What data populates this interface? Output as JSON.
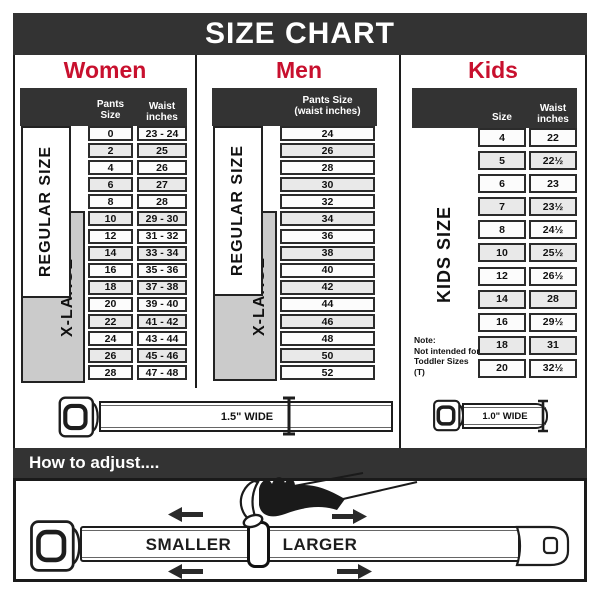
{
  "title_bar": {
    "title": "SIZE CHART"
  },
  "colors": {
    "accent_red": "#c8102e",
    "bar_dark": "#333333",
    "cell_border": "#2b2b2b",
    "row_alt": "#e9e9e9",
    "xlarge_gray": "#cbcbcb"
  },
  "sections": {
    "women": {
      "title": "Women",
      "side_labels": {
        "regular": "REGULAR SIZE",
        "xlarge": "X-LARGE"
      },
      "headers": {
        "col1": "Pants Size",
        "col2_line1": "Waist",
        "col2_line2": "inches"
      },
      "rows": [
        [
          "0",
          "23 - 24"
        ],
        [
          "2",
          "25"
        ],
        [
          "4",
          "26"
        ],
        [
          "6",
          "27"
        ],
        [
          "8",
          "28"
        ],
        [
          "10",
          "29 - 30"
        ],
        [
          "12",
          "31 - 32"
        ],
        [
          "14",
          "33 - 34"
        ],
        [
          "16",
          "35 - 36"
        ],
        [
          "18",
          "37 - 38"
        ],
        [
          "20",
          "39 - 40"
        ],
        [
          "22",
          "41 - 42"
        ],
        [
          "24",
          "43 - 44"
        ],
        [
          "26",
          "45 - 46"
        ],
        [
          "28",
          "47 - 48"
        ]
      ],
      "belt": {
        "width_label": "1.5\" WIDE"
      }
    },
    "men": {
      "title": "Men",
      "side_labels": {
        "regular": "REGULAR SIZE",
        "xlarge": "X-LARGE"
      },
      "headers": {
        "line1": "Pants Size",
        "line2": "(waist inches)"
      },
      "rows": [
        [
          "24"
        ],
        [
          "26"
        ],
        [
          "28"
        ],
        [
          "30"
        ],
        [
          "32"
        ],
        [
          "34"
        ],
        [
          "36"
        ],
        [
          "38"
        ],
        [
          "40"
        ],
        [
          "42"
        ],
        [
          "44"
        ],
        [
          "46"
        ],
        [
          "48"
        ],
        [
          "50"
        ],
        [
          "52"
        ]
      ]
    },
    "kids": {
      "title": "Kids",
      "side_label": "KIDS SIZE",
      "headers": {
        "col1": "Size",
        "col2_line1": "Waist",
        "col2_line2": "inches"
      },
      "rows": [
        [
          "4",
          "22"
        ],
        [
          "5",
          "22½"
        ],
        [
          "6",
          "23"
        ],
        [
          "7",
          "23½"
        ],
        [
          "8",
          "24½"
        ],
        [
          "10",
          "25½"
        ],
        [
          "12",
          "26½"
        ],
        [
          "14",
          "28"
        ],
        [
          "16",
          "29½"
        ],
        [
          "18",
          "31"
        ],
        [
          "20",
          "32½"
        ]
      ],
      "note_lines": [
        "Note:",
        "Not intended for",
        "Toddler Sizes (T)"
      ],
      "belt": {
        "width_label": "1.0\" WIDE"
      }
    }
  },
  "adjust": {
    "bar_title": "How to adjust....",
    "smaller_label": "SMALLER",
    "larger_label": "LARGER"
  }
}
